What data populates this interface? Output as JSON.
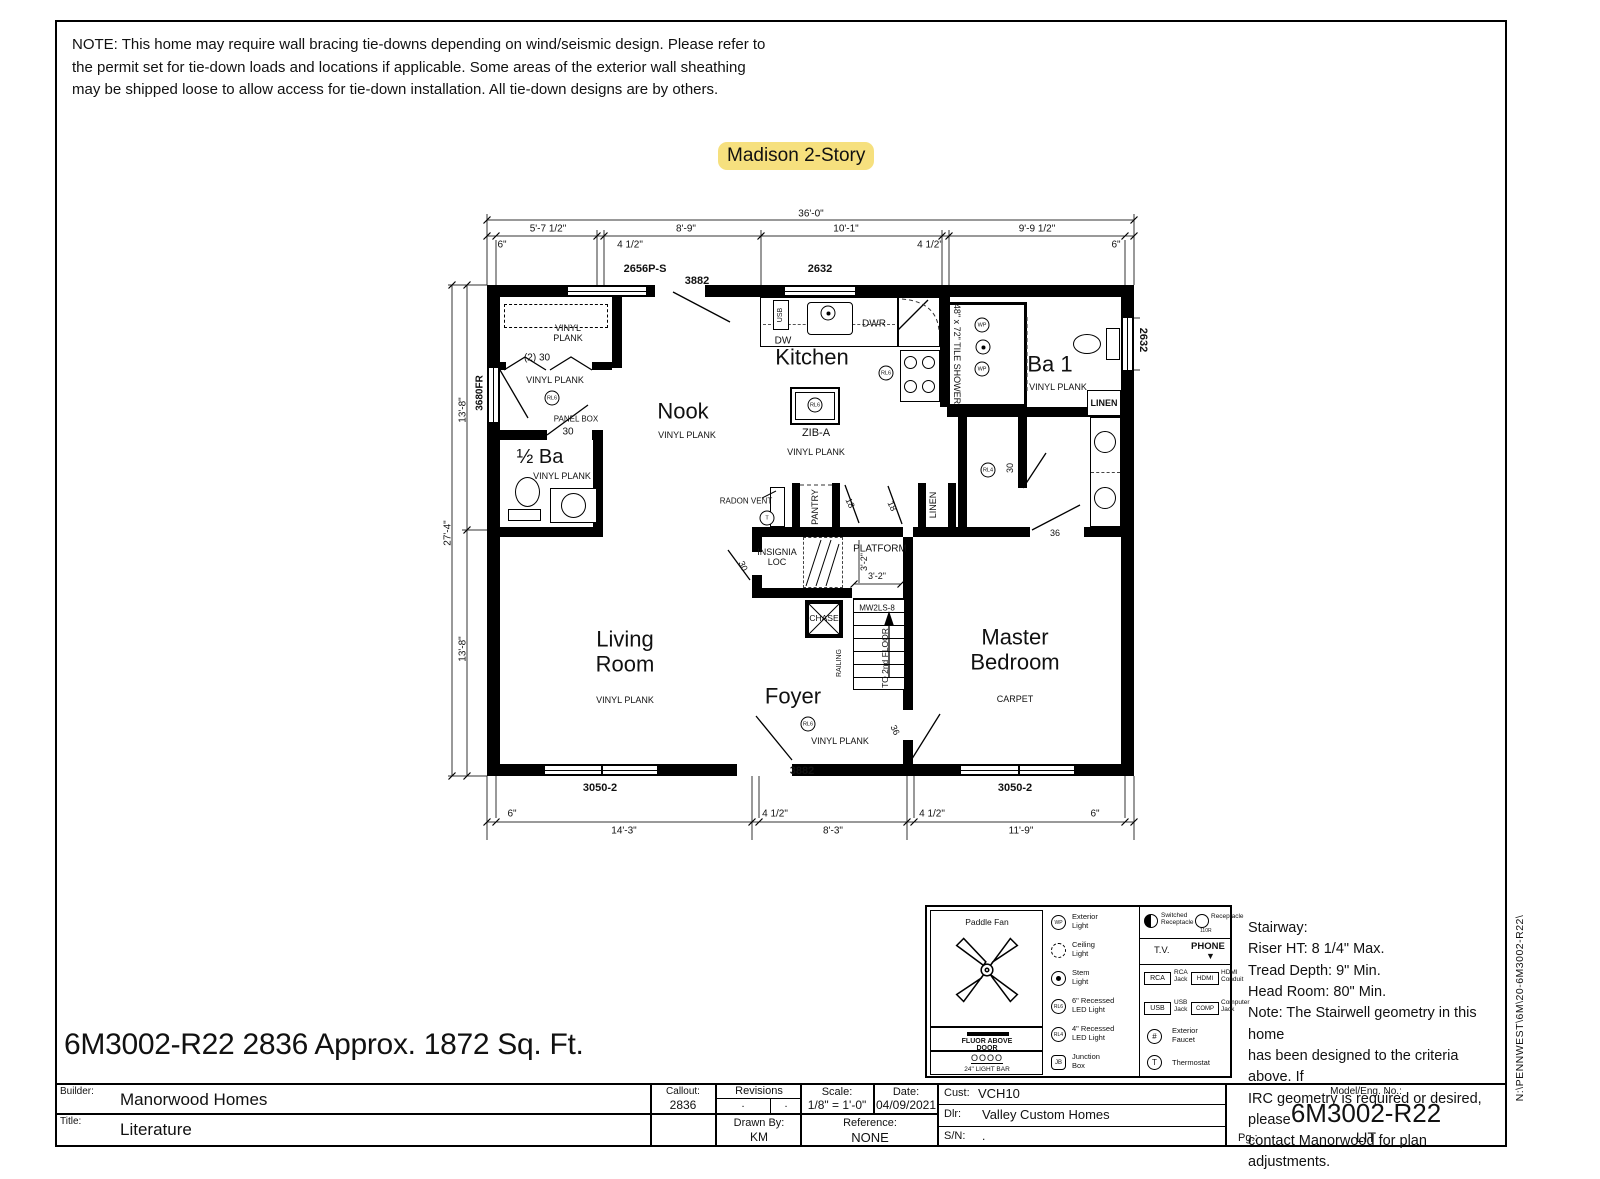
{
  "note": "NOTE:  This home may require wall bracing tie-downs depending on wind/seismic design. Please refer to\nthe permit set for tie-down loads and locations if applicable. Some areas of the exterior wall sheathing\nmay be shipped loose to allow access for tie-down installation. All tie-down designs are by others.",
  "plan_title": "Madison 2-Story",
  "highlight_color": "#F6E07E",
  "footer_line": "6M3002-R22 2836  Approx. 1872 Sq. Ft.",
  "margin_path": "N:\\PENNWEST\\6M\\20-6M3002-R22\\",
  "stairway_note": "Stairway:\nRiser HT: 8 1/4\" Max.\nTread Depth: 9\" Min.\nHead Room: 80\" Min.\nNote: The Stairwell geometry in this home\nhas been designed to the criteria above. If\nIRC geometry is required or desired, please\ncontact Manorwood for plan adjustments.",
  "plan": {
    "labels": [
      {
        "t": "36'-0\"",
        "x": 371,
        "y": 14,
        "fs": 10
      },
      {
        "t": "5'-7 1/2\"",
        "x": 108,
        "y": 29,
        "fs": 10
      },
      {
        "t": "8'-9\"",
        "x": 246,
        "y": 29,
        "fs": 10
      },
      {
        "t": "10'-1\"",
        "x": 406,
        "y": 29,
        "fs": 10
      },
      {
        "t": "9'-9 1/2\"",
        "x": 597,
        "y": 29,
        "fs": 10
      },
      {
        "t": "6\"",
        "x": 62,
        "y": 45,
        "fs": 10
      },
      {
        "t": "4 1/2\"",
        "x": 190,
        "y": 45,
        "fs": 10
      },
      {
        "t": "4 1/2\"",
        "x": 490,
        "y": 45,
        "fs": 10
      },
      {
        "t": "6\"",
        "x": 676,
        "y": 45,
        "fs": 10
      },
      {
        "t": "2656P-S",
        "x": 205,
        "y": 69,
        "fs": 11,
        "w": 700
      },
      {
        "t": "3882",
        "x": 257,
        "y": 81,
        "fs": 11,
        "w": 700
      },
      {
        "t": "2632",
        "x": 380,
        "y": 69,
        "fs": 11,
        "w": 700
      },
      {
        "t": "2632",
        "x": 703,
        "y": 140,
        "fs": 11,
        "w": 700,
        "rot": 90
      },
      {
        "t": "3680FR",
        "x": 40,
        "y": 193,
        "fs": 10,
        "w": 700,
        "rot": -90
      },
      {
        "t": "13'-8\"",
        "x": 23,
        "y": 210,
        "fs": 10,
        "rot": -90
      },
      {
        "t": "27'-4\"",
        "x": 8,
        "y": 333,
        "fs": 10,
        "rot": -90
      },
      {
        "t": "13'-8\"",
        "x": 23,
        "y": 449,
        "fs": 10,
        "rot": -90
      },
      {
        "t": "VINYL\nPLANK",
        "x": 128,
        "y": 133,
        "fs": 9
      },
      {
        "t": "(2) 30",
        "x": 97,
        "y": 158,
        "fs": 10
      },
      {
        "t": "VINYL PLANK",
        "x": 115,
        "y": 180,
        "fs": 9
      },
      {
        "t": "PANEL BOX",
        "x": 136,
        "y": 220,
        "fs": 8
      },
      {
        "t": "30",
        "x": 128,
        "y": 232,
        "fs": 10
      },
      {
        "t": "½ Ba",
        "x": 100,
        "y": 257,
        "fs": 20
      },
      {
        "t": "VINYL PLANK",
        "x": 122,
        "y": 276,
        "fs": 9
      },
      {
        "t": "Nook",
        "x": 243,
        "y": 212,
        "fs": 22
      },
      {
        "t": "VINYL PLANK",
        "x": 247,
        "y": 235,
        "fs": 9
      },
      {
        "t": "Kitchen",
        "x": 372,
        "y": 158,
        "fs": 22
      },
      {
        "t": "DW",
        "x": 343,
        "y": 141,
        "fs": 10
      },
      {
        "t": "DWR",
        "x": 434,
        "y": 124,
        "fs": 10
      },
      {
        "t": "USB",
        "x": 341,
        "y": 115,
        "fs": 7,
        "rot": -90
      },
      {
        "t": "ZIB-A",
        "x": 376,
        "y": 233,
        "fs": 11
      },
      {
        "t": "VINYL PLANK",
        "x": 376,
        "y": 252,
        "fs": 9
      },
      {
        "t": "48\" x 72\" TILE SHOWER",
        "x": 517,
        "y": 154,
        "fs": 9,
        "rot": 90
      },
      {
        "t": "Ba 1",
        "x": 610,
        "y": 165,
        "fs": 22
      },
      {
        "t": "VINYL PLANK",
        "x": 618,
        "y": 187,
        "fs": 9
      },
      {
        "t": "LINEN",
        "x": 664,
        "y": 203,
        "fs": 9,
        "w": 700
      },
      {
        "t": "RADON VENT",
        "x": 306,
        "y": 302,
        "fs": 8
      },
      {
        "t": "PANTRY",
        "x": 375,
        "y": 307,
        "fs": 9,
        "rot": -90
      },
      {
        "t": "18",
        "x": 410,
        "y": 303,
        "fs": 9,
        "rot": 65
      },
      {
        "t": "18",
        "x": 452,
        "y": 306,
        "fs": 9,
        "rot": 65
      },
      {
        "t": "LINEN",
        "x": 493,
        "y": 305,
        "fs": 9,
        "rot": -90
      },
      {
        "t": "INSIGNIA\nLOC",
        "x": 337,
        "y": 357,
        "fs": 9
      },
      {
        "t": "30",
        "x": 303,
        "y": 366,
        "fs": 9,
        "rot": 65
      },
      {
        "t": "PLATFORM",
        "x": 440,
        "y": 349,
        "fs": 10
      },
      {
        "t": "3'-2\"",
        "x": 424,
        "y": 362,
        "fs": 9,
        "rot": -90
      },
      {
        "t": "3'-2\"",
        "x": 437,
        "y": 376,
        "fs": 9
      },
      {
        "t": "CHASE",
        "x": 384,
        "y": 419,
        "fs": 8.5
      },
      {
        "t": "MW2LS-8",
        "x": 437,
        "y": 409,
        "fs": 8
      },
      {
        "t": "TO 2nd FLOOR",
        "x": 446,
        "y": 458,
        "fs": 8.5,
        "rot": -90
      },
      {
        "t": "RAILING",
        "x": 400,
        "y": 463,
        "fs": 7,
        "rot": -90
      },
      {
        "t": "30",
        "x": 570,
        "y": 268,
        "fs": 9,
        "rot": -90
      },
      {
        "t": "36",
        "x": 615,
        "y": 333,
        "fs": 9
      },
      {
        "t": "36",
        "x": 455,
        "y": 530,
        "fs": 9,
        "rot": 65
      },
      {
        "t": "Living\nRoom",
        "x": 185,
        "y": 452,
        "fs": 22
      },
      {
        "t": "VINYL PLANK",
        "x": 185,
        "y": 500,
        "fs": 9
      },
      {
        "t": "Foyer",
        "x": 353,
        "y": 497,
        "fs": 22
      },
      {
        "t": "VINYL PLANK",
        "x": 400,
        "y": 541,
        "fs": 9
      },
      {
        "t": "Master\nBedroom",
        "x": 575,
        "y": 450,
        "fs": 22
      },
      {
        "t": "CARPET",
        "x": 575,
        "y": 499,
        "fs": 9
      },
      {
        "t": "3882",
        "x": 362,
        "y": 571,
        "fs": 11,
        "w": 700
      },
      {
        "t": "3050-2",
        "x": 160,
        "y": 588,
        "fs": 11,
        "w": 700
      },
      {
        "t": "3050-2",
        "x": 575,
        "y": 588,
        "fs": 11,
        "w": 700
      },
      {
        "t": "6\"",
        "x": 72,
        "y": 614,
        "fs": 10
      },
      {
        "t": "4 1/2\"",
        "x": 335,
        "y": 614,
        "fs": 10
      },
      {
        "t": "4 1/2\"",
        "x": 492,
        "y": 614,
        "fs": 10
      },
      {
        "t": "6\"",
        "x": 655,
        "y": 614,
        "fs": 10
      },
      {
        "t": "14'-3\"",
        "x": 184,
        "y": 631,
        "fs": 10
      },
      {
        "t": "8'-3\"",
        "x": 393,
        "y": 631,
        "fs": 10
      },
      {
        "t": "11'-9\"",
        "x": 581,
        "y": 631,
        "fs": 10
      }
    ],
    "circles": [
      {
        "t": "RL6",
        "x": 112,
        "y": 198
      },
      {
        "t": "RL6",
        "x": 446,
        "y": 173
      },
      {
        "t": "RL6",
        "x": 375,
        "y": 205
      },
      {
        "t": "RL6",
        "x": 368,
        "y": 524
      },
      {
        "t": "RL4",
        "x": 548,
        "y": 270
      },
      {
        "t": "T",
        "x": 327,
        "y": 318
      },
      {
        "t": "WP",
        "x": 542,
        "y": 125
      },
      {
        "t": "WP",
        "x": 542,
        "y": 169
      },
      {
        "t": "dot",
        "x": 543,
        "y": 147
      },
      {
        "t": "dot",
        "x": 388,
        "y": 113
      }
    ]
  },
  "legend": {
    "paddle_fan": "Paddle Fan",
    "fluor": "FLUOR ABOVE DOOR",
    "lightbar": "24\" LIGHT BAR",
    "lightbar_sym": "OOOO",
    "wp": "WP",
    "exterior_light": "Exterior\nLight",
    "ceiling_light": "Ceiling\nLight",
    "stem_light": "Stem\nLight",
    "rl6": "RL6",
    "rl6_label": "6\" Recessed\nLED Light",
    "rl4": "RL4",
    "rl4_label": "4\" Recessed\nLED Light",
    "jb": "JB",
    "jb_label": "Junction\nBox",
    "switched": "Switched\nReceptacle",
    "receptacle": "Receptacle",
    "receptacle_sub": "110R",
    "tv": "T.V.",
    "phone": "PHONE",
    "phone_arrow": "▼",
    "rca": "RCA",
    "rca_label": "RCA\nJack",
    "hdmi": "HDMI",
    "hdmi_label": "HDMI\nConduit",
    "usb": "USB",
    "usb_label": "USB\nJack",
    "comp": "COMP",
    "comp_label": "Computer\nJack",
    "faucet_sym": "#",
    "faucet_label": "Exterior\nFaucet",
    "thermo_sym": "T",
    "thermo_label": "Thermostat"
  },
  "titleblock": {
    "builder_label": "Builder:",
    "builder": "Manorwood Homes",
    "title_label": "Title:",
    "title": "Literature",
    "callout_label": "Callout:",
    "callout": "2836",
    "revisions_label": "Revisions",
    "rev1": ".",
    "rev2": ".",
    "drawnby_label": "Drawn By:",
    "drawnby": "KM",
    "scale_label": "Scale:",
    "scale": "1/8\" = 1'-0\"",
    "date_label": "Date:",
    "date": "04/09/2021",
    "reference_label": "Reference:",
    "reference": "NONE",
    "cust_label": "Cust:",
    "cust": "VCH10",
    "dlr_label": "Dlr:",
    "dlr": "Valley Custom Homes",
    "sn_label": "S/N:",
    "sn": ".",
    "model_label": "Model/Eng. No.:",
    "model": "6M3002-R22",
    "pg_label": "Pg.:",
    "pg": "LIT"
  }
}
